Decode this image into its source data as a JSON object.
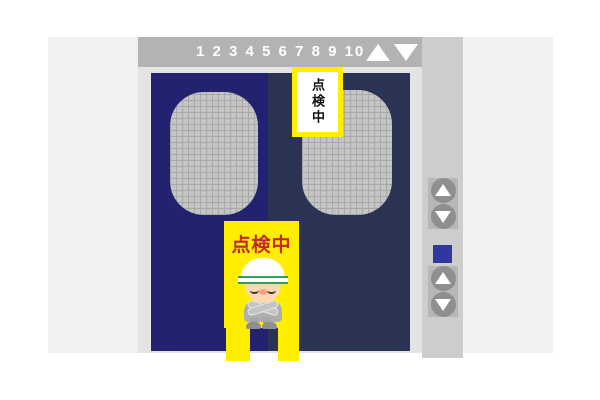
{
  "indicator": {
    "floors": "1 2 3 4 5 6 7 8 9 10"
  },
  "signs": {
    "hanging": {
      "text": "点検中"
    },
    "standing": {
      "text": "点検中"
    }
  },
  "icons": {
    "indicator_up": "up-triangle",
    "indicator_down": "down-triangle",
    "call_up": "up-triangle",
    "call_down": "down-triangle"
  },
  "colors": {
    "wall": "#f1f1f1",
    "indicator_bar": "#b3b3b3",
    "door_left": "#232270",
    "door_right": "#2b3355",
    "window_mesh": "#c5c5c5",
    "sign_yellow": "#ffee00",
    "sign_text_red": "#c22a2a",
    "panel_strip": "#cdcdcd",
    "floor_plate_blue": "#3038a0"
  }
}
